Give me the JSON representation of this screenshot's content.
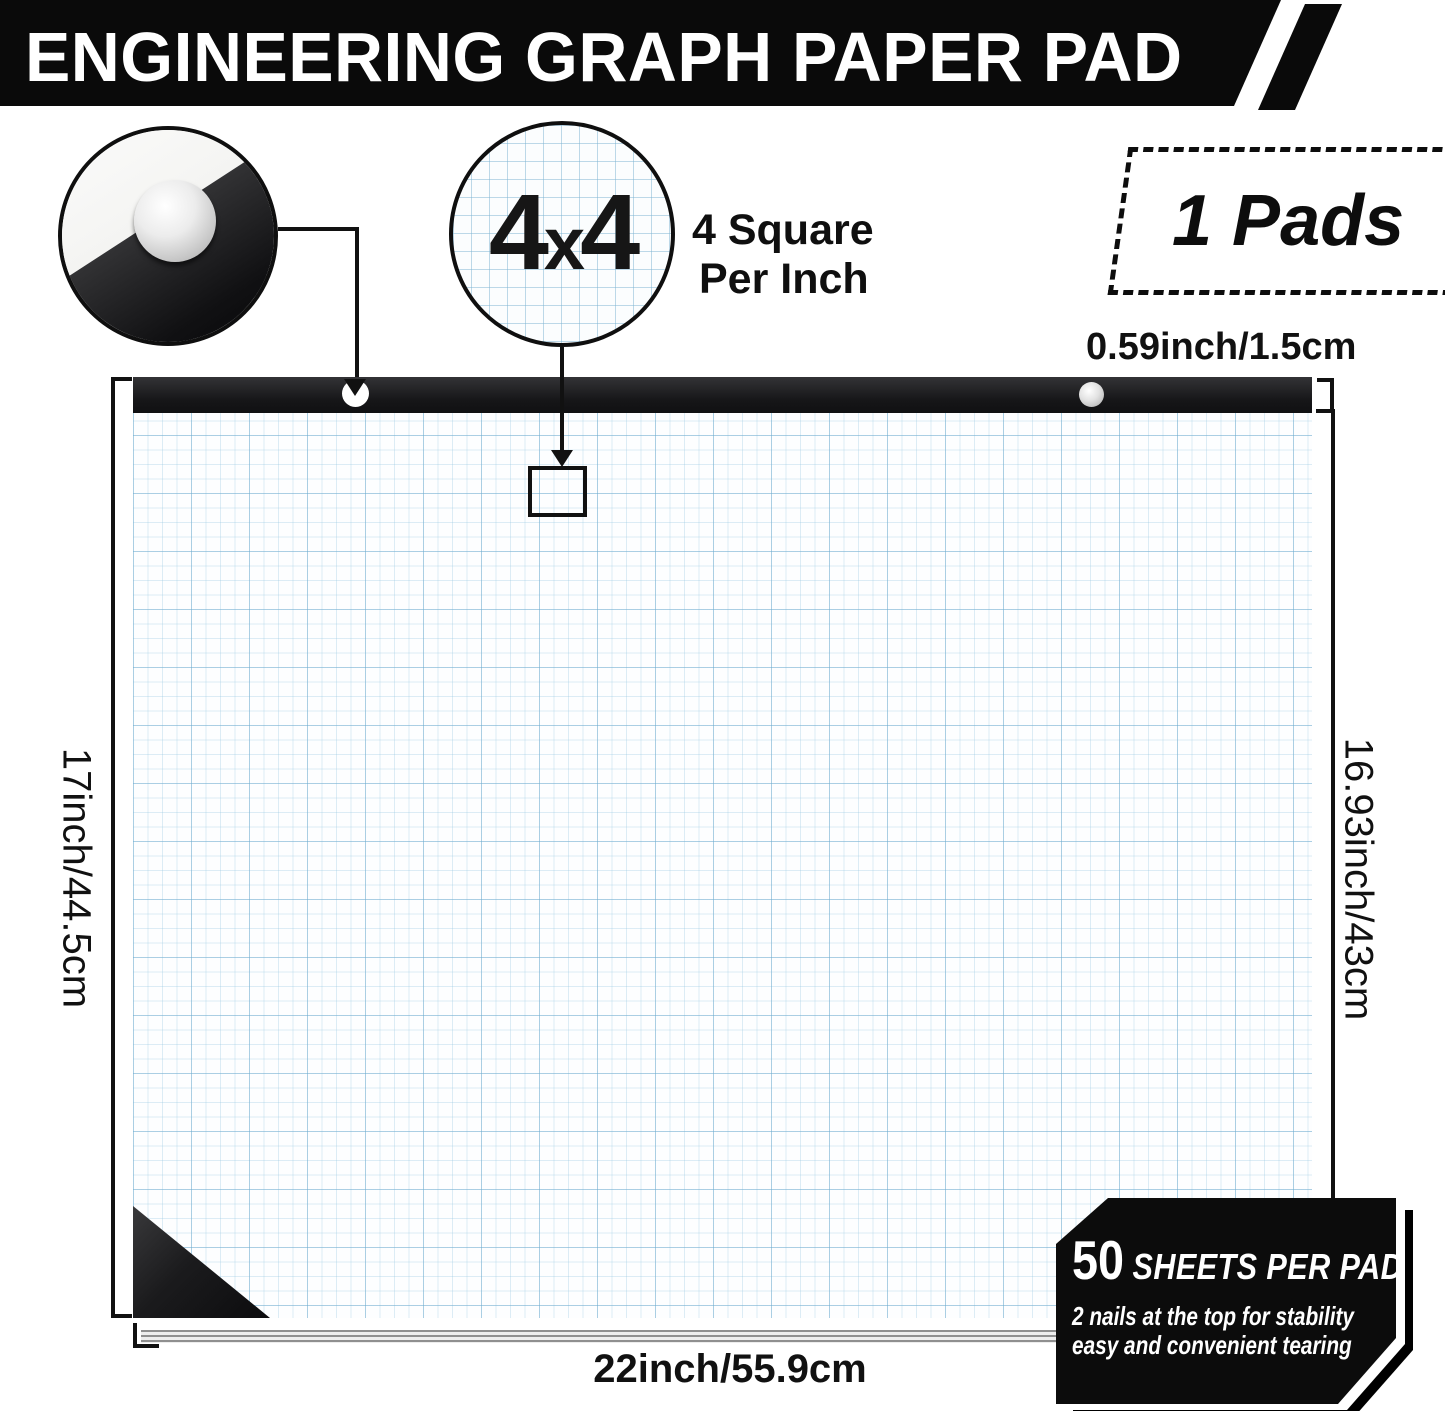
{
  "banner": {
    "title": "ENGINEERING GRAPH PAPER PAD"
  },
  "grid_magnifier": {
    "label": "4x4",
    "parts": {
      "p1": "4",
      "x": "x",
      "p2": "4"
    },
    "caption_line1": "4 Square",
    "caption_line2": "Per Inch"
  },
  "pads_box": {
    "label": "1 Pads"
  },
  "dimensions": {
    "header_height": "0.59inch/1.5cm",
    "left": "17inch/44.5cm",
    "right": "16.93inch/43cm",
    "bottom": "22inch/55.9cm"
  },
  "sheets_badge": {
    "count": "50",
    "count_suffix": "SHEETS PER PAD",
    "line1": "2 nails at the top for stability",
    "line2": "easy and convenient tearing"
  },
  "icons": {
    "down_arrow_icon": "▼",
    "nail_icon": "●",
    "magnifier_circle_icon": "○"
  },
  "colors": {
    "banner_bg": "#0a0a0a",
    "pad_header_bg": "#1d1d1f",
    "paper_bg": "#fdfeff",
    "grid_line_minor": "#bcd9e6",
    "grid_line_major": "#9cc4d8",
    "badge_bg": "#0c0c0c",
    "cardboard_edge": "#b79c72",
    "nail_silver": "#d9d9d9",
    "text": "#111111"
  }
}
